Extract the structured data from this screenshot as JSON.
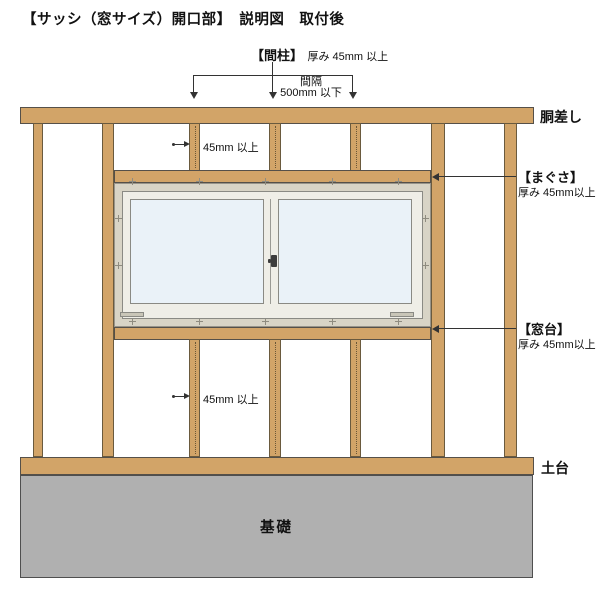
{
  "title": "【サッシ（窓サイズ）開口部】　説明図　取付後",
  "colors": {
    "wood": "#d2a468",
    "foundation_gray": "#b0b0b0",
    "window_fin": "#d8d4c6",
    "sash_white": "#efeee7",
    "glass_blue": "#eaf2f8",
    "text": "#111111"
  },
  "labels": {
    "mabashira": {
      "name": "【間柱】",
      "spec": "厚み 45mm 以上"
    },
    "kankaku": {
      "line1": "間隔",
      "line2": "500mm 以下"
    },
    "dousashi": "胴差し",
    "magusa": {
      "name": "【まぐさ】",
      "spec": "厚み 45mm以上"
    },
    "madodai": {
      "name": "【窓台】",
      "spec": "厚み 45mm以上"
    },
    "dim_45_upper": "45mm 以上",
    "dim_45_lower": "45mm 以上",
    "dodai": "土台",
    "kiso": "基礎"
  }
}
